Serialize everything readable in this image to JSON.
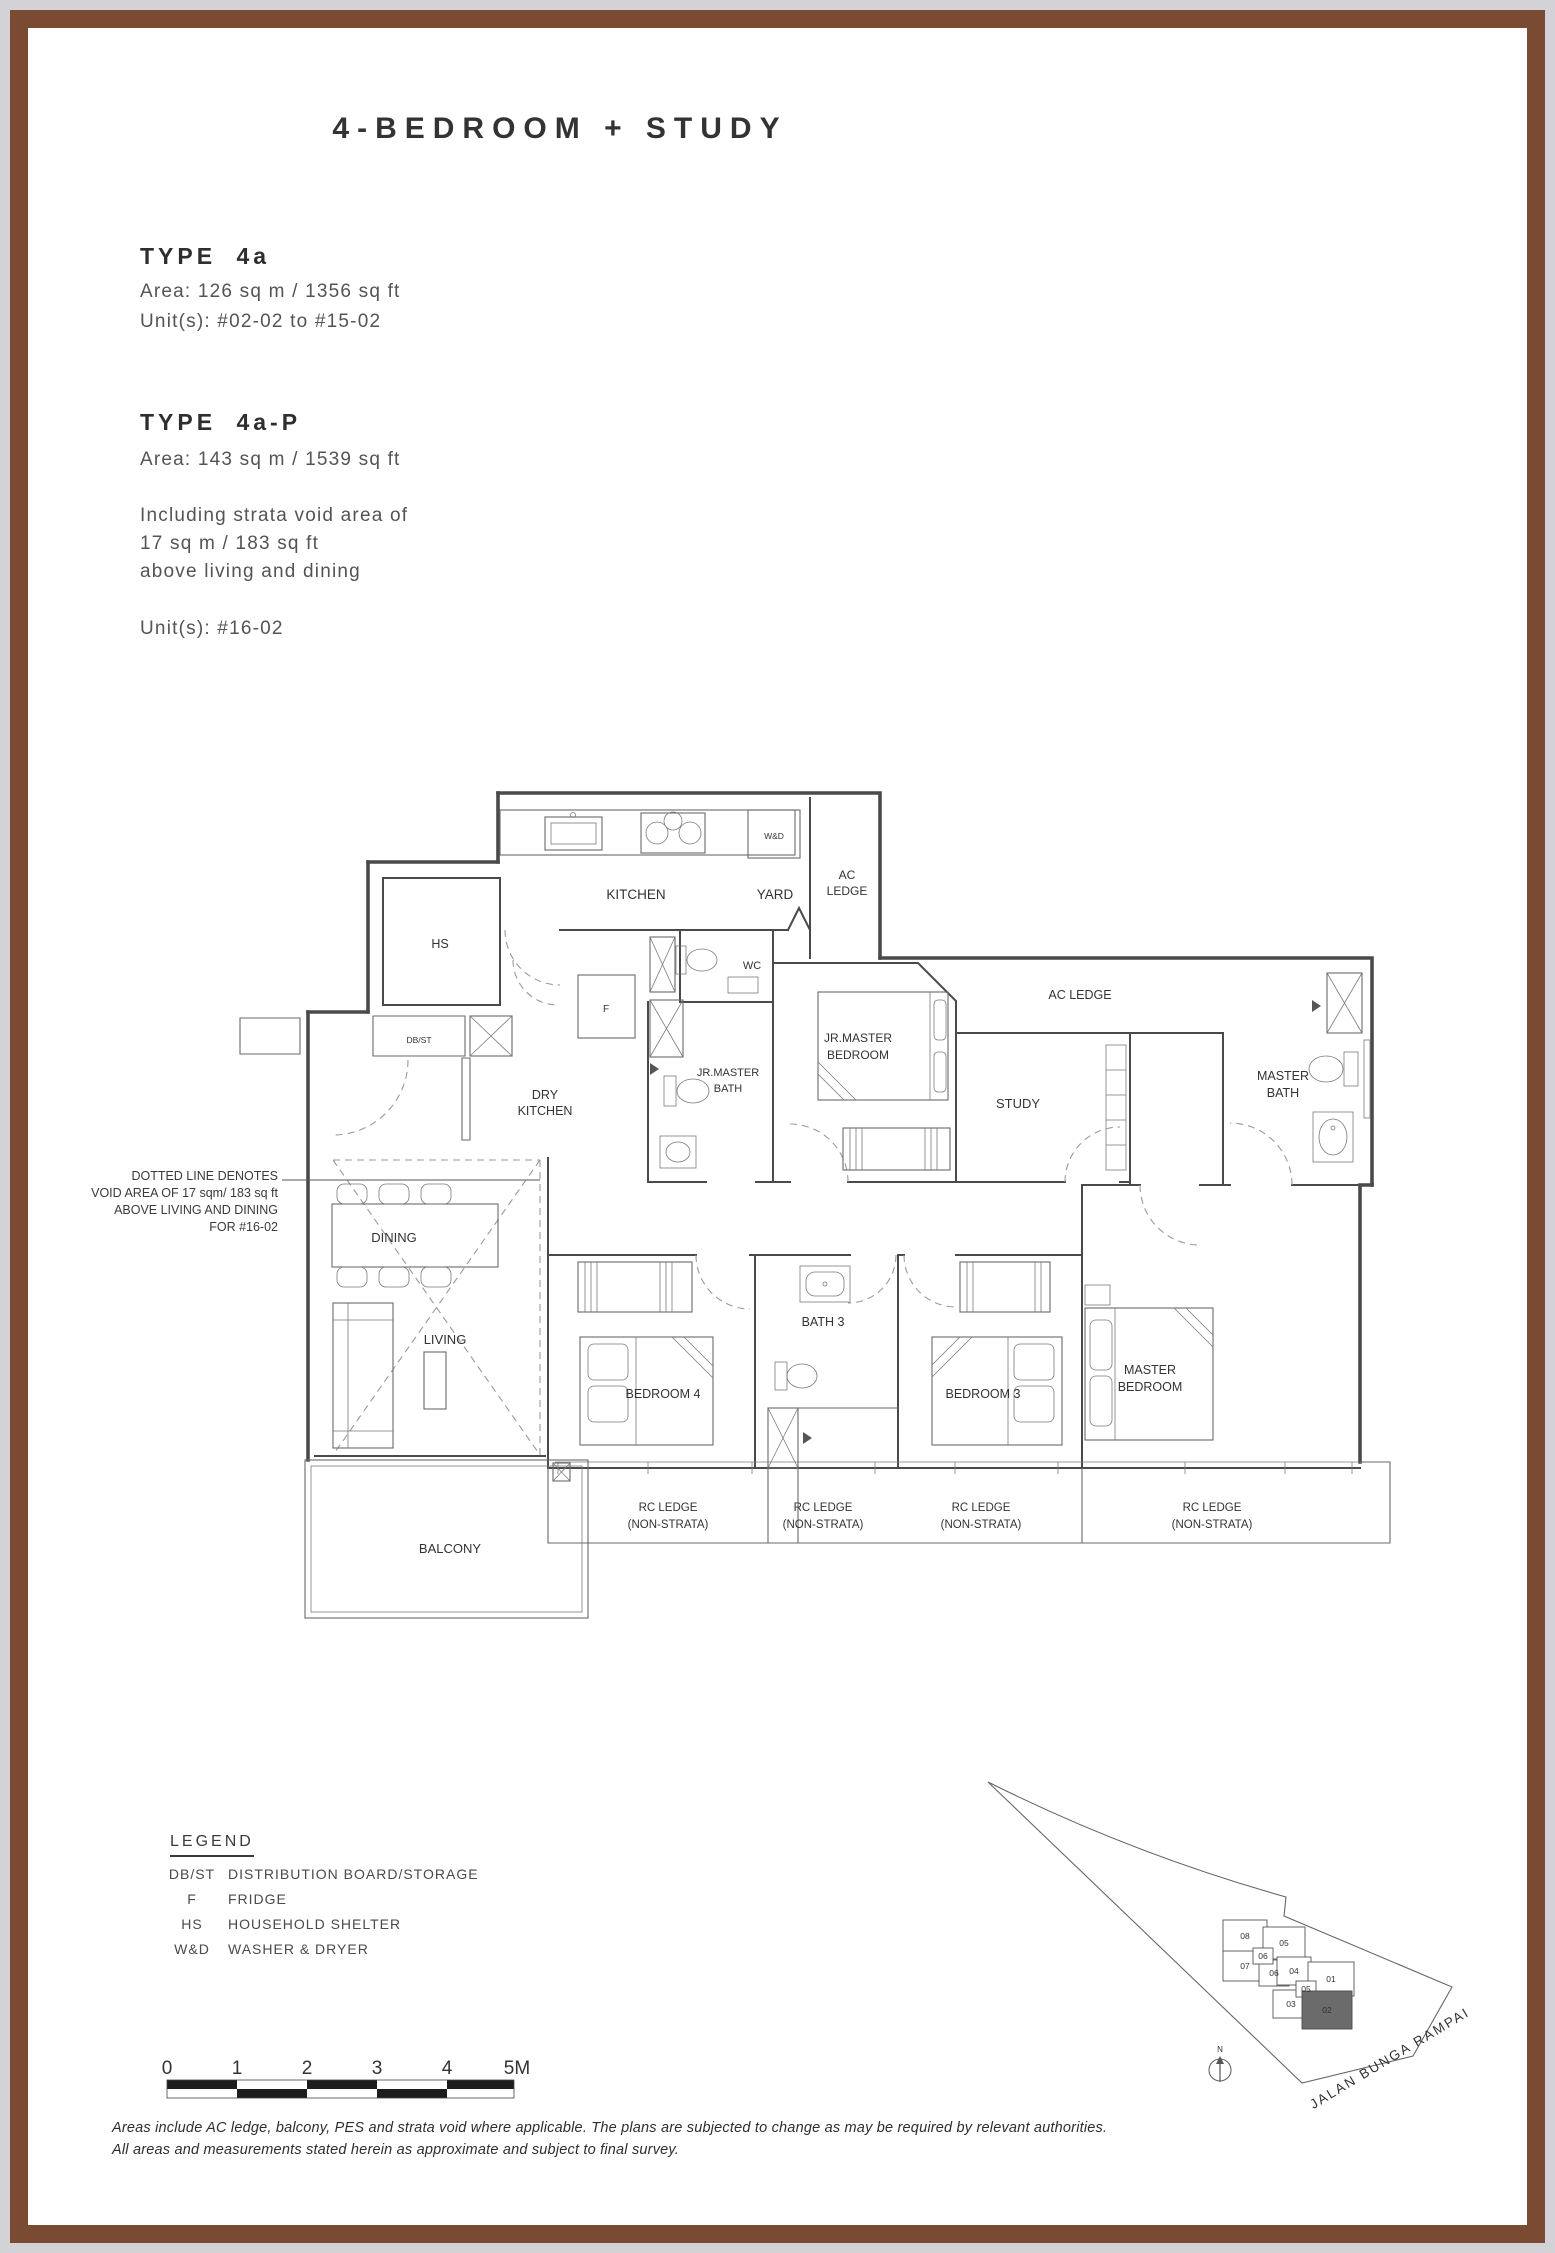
{
  "page": {
    "title": "4-BEDROOM + STUDY"
  },
  "types": [
    {
      "name": "TYPE 4a",
      "area": "Area: 126 sq m / 1356 sq ft",
      "units": "Unit(s): #02-02 to #15-02"
    },
    {
      "name": "TYPE 4a-P",
      "area": "Area: 143 sq m / 1539 sq ft",
      "lines": [
        "Including strata void area of",
        "17 sq m / 183 sq ft",
        "above living and dining"
      ],
      "units": "Unit(s): #16-02"
    }
  ],
  "plan": {
    "note": [
      "DOTTED LINE DENOTES",
      "VOID AREA OF 17 sqm/ 183 sq ft",
      "ABOVE LIVING AND DINING",
      "FOR #16-02"
    ],
    "rooms": {
      "kitchen": "KITCHEN",
      "yard": "YARD",
      "ac_ledge_1": "AC",
      "ac_ledge_2": "LEDGE",
      "wd": "W&D",
      "hs": "HS",
      "dbst": "DB/ST",
      "dry_1": "DRY",
      "dry_2": "KITCHEN",
      "wc": "WC",
      "fridge": "F",
      "jr_bath_1": "JR.MASTER",
      "jr_bath_2": "BATH",
      "jr_bed_1": "JR.MASTER",
      "jr_bed_2": "BEDROOM",
      "study": "STUDY",
      "ac_ledge_right": "AC LEDGE",
      "master_bath_1": "MASTER",
      "master_bath_2": "BATH",
      "dining": "DINING",
      "living": "LIVING",
      "bedroom4": "BEDROOM 4",
      "bath3": "BATH 3",
      "bedroom3": "BEDROOM 3",
      "master_bed_1": "MASTER",
      "master_bed_2": "BEDROOM",
      "balcony": "BALCONY",
      "rc_1": "RC LEDGE",
      "rc_2": "(NON-STRATA)"
    }
  },
  "legend": {
    "title": "LEGEND",
    "items": [
      {
        "abbr": "DB/ST",
        "desc": "DISTRIBUTION BOARD/STORAGE"
      },
      {
        "abbr": "F",
        "desc": "FRIDGE"
      },
      {
        "abbr": "HS",
        "desc": "HOUSEHOLD SHELTER"
      },
      {
        "abbr": "W&D",
        "desc": "WASHER & DRYER"
      }
    ]
  },
  "scale": {
    "ticks": [
      "0",
      "1",
      "2",
      "3",
      "4",
      "5M"
    ]
  },
  "site_map": {
    "road": "JALAN BUNGA RAMPAI",
    "north": "N",
    "blocks": [
      {
        "label": "08"
      },
      {
        "label": "05"
      },
      {
        "label": "06"
      },
      {
        "label": "07"
      },
      {
        "label": "06"
      },
      {
        "label": "04"
      },
      {
        "label": "05"
      },
      {
        "label": "01"
      },
      {
        "label": "03"
      },
      {
        "label": "02",
        "highlighted": true
      }
    ]
  },
  "disclaimer": [
    "Areas include AC ledge, balcony, PES and strata void where applicable. The plans are subjected to change as may be required by relevant authorities.",
    "All areas and measurements stated herein as approximate and subject to final survey."
  ]
}
